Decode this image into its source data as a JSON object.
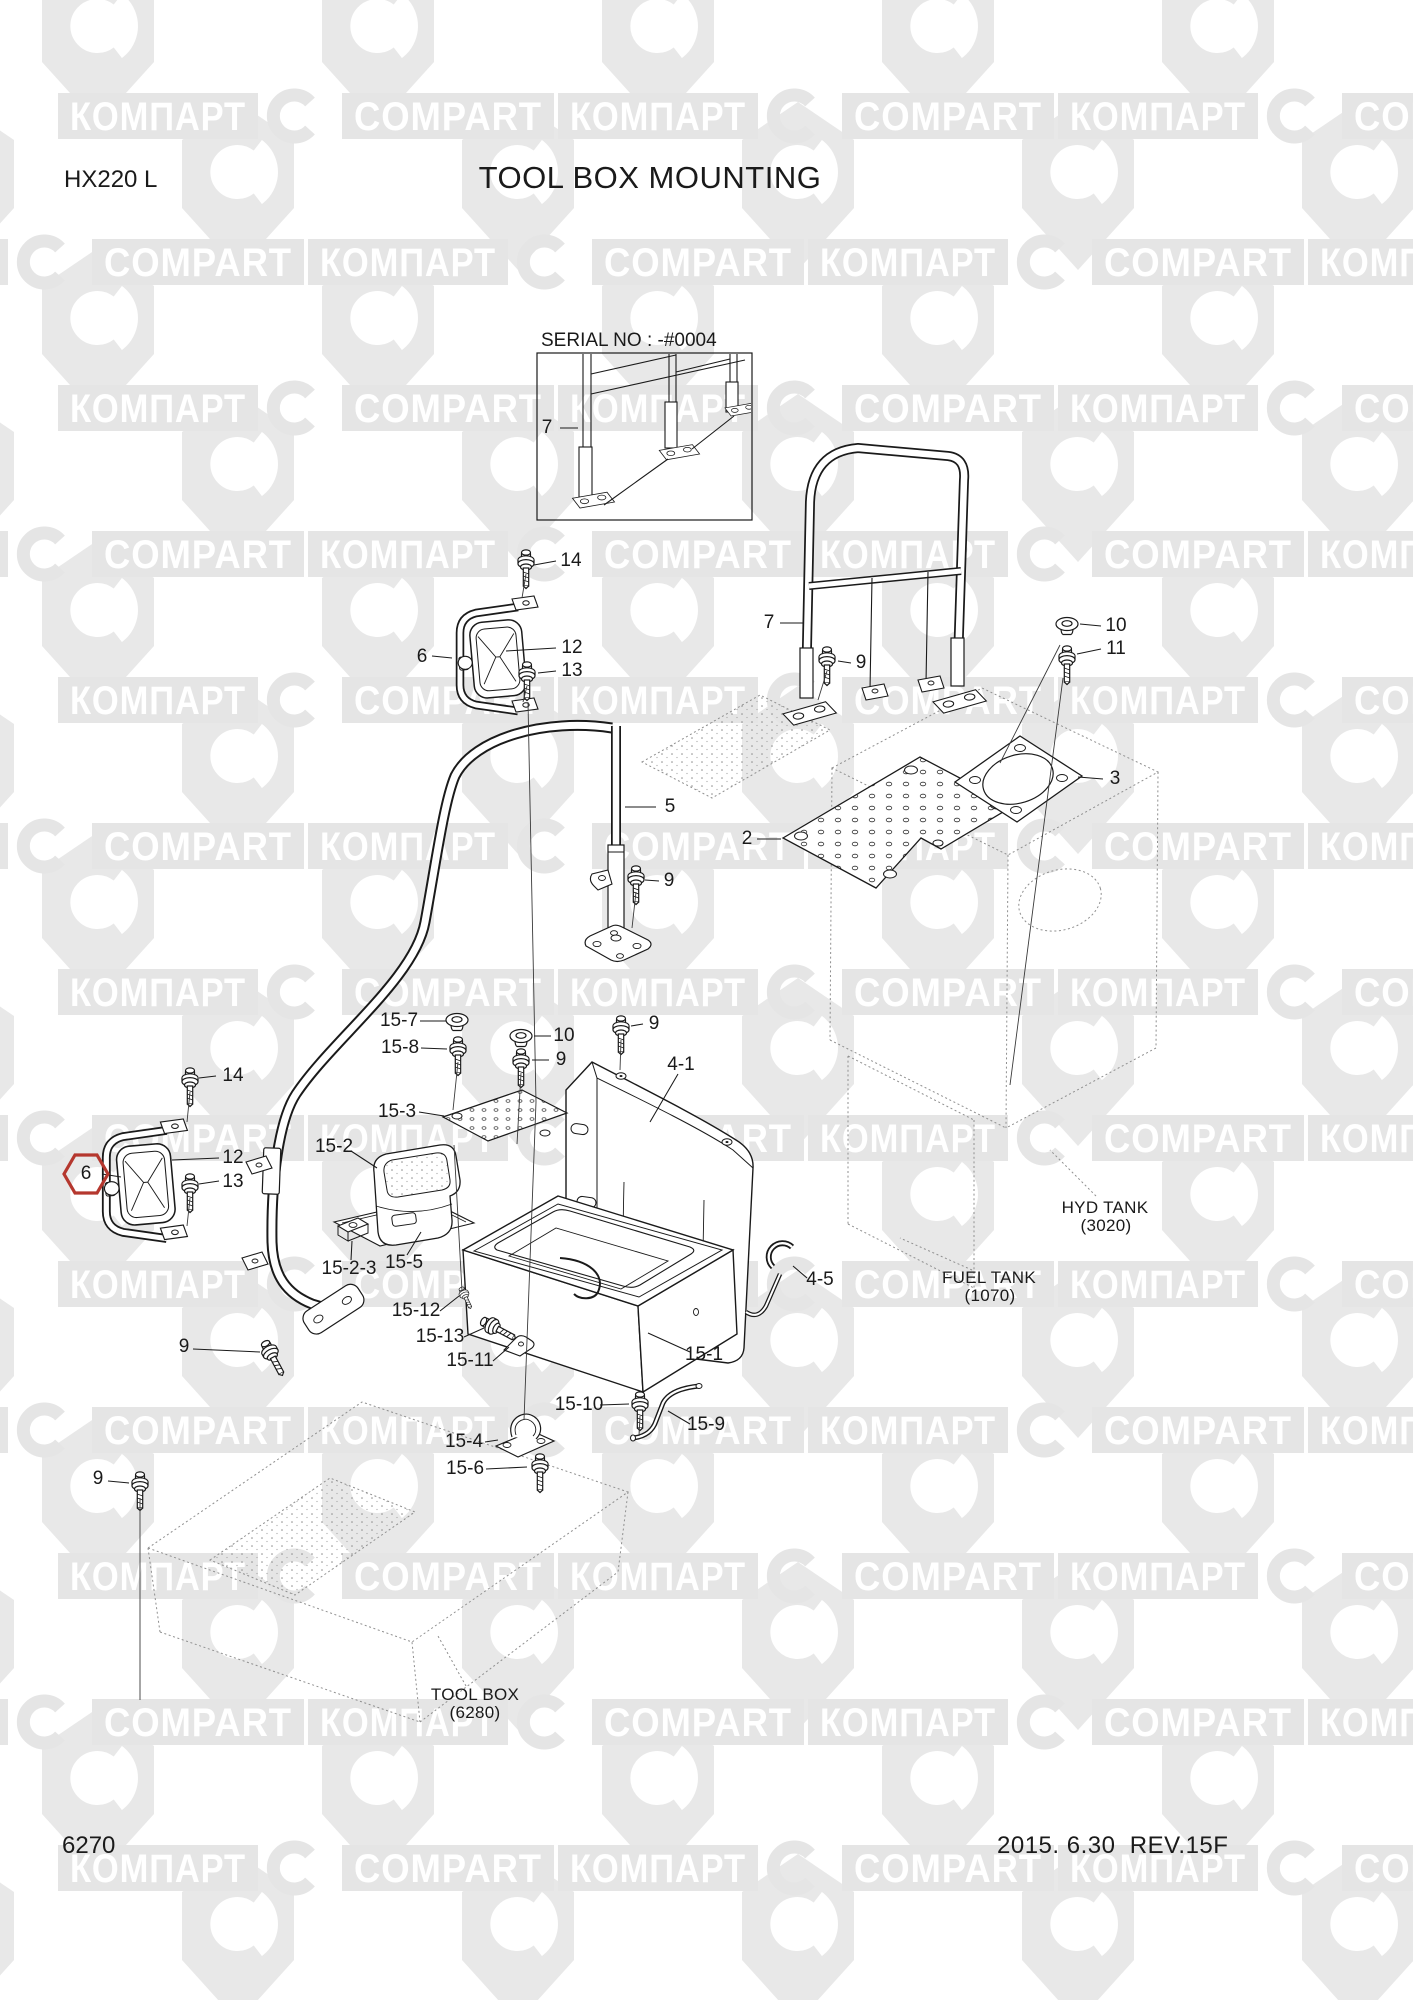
{
  "header": {
    "model": "HX220 L",
    "title": "TOOL BOX MOUNTING"
  },
  "serial_box": {
    "label": "SERIAL NO : -#0004"
  },
  "watermark": {
    "ru": "КОМПАРТ",
    "en": "COMPART"
  },
  "callouts": {
    "c7_box": "7",
    "c14_top": "14",
    "c6_top": "6",
    "c12_top": "12",
    "c13_top": "13",
    "c5": "5",
    "c9_step": "9",
    "c7_rail": "7",
    "c9_rail": "9",
    "c10": "10",
    "c11": "11",
    "c3": "3",
    "c2": "2",
    "c15_7": "15-7",
    "c15_8": "15-8",
    "c10_b": "10",
    "c9_b": "9",
    "c9_c": "9",
    "c4_1": "4-1",
    "c15_3": "15-3",
    "c15_2": "15-2",
    "c14_b": "14",
    "c6_b": "6",
    "c12_b": "12",
    "c13_b": "13",
    "c15_2_3": "15-2-3",
    "c15_5": "15-5",
    "c15_12": "15-12",
    "c15_13": "15-13",
    "c15_11": "15-11",
    "c9_d": "9",
    "c15_1": "15-1",
    "c15_10": "15-10",
    "c15_9": "15-9",
    "c15_4": "15-4",
    "c15_6": "15-6",
    "c9_e": "9",
    "c4_5": "4-5"
  },
  "references": {
    "hyd_tank_line1": "HYD TANK",
    "hyd_tank_line2": "(3020)",
    "fuel_tank_line1": "FUEL TANK",
    "fuel_tank_line2": "(1070)",
    "tool_box_line1": "TOOL BOX",
    "tool_box_line2": "(6280)"
  },
  "footer": {
    "page_number": "6270",
    "revision": "2015. 6.30  REV.15F"
  }
}
